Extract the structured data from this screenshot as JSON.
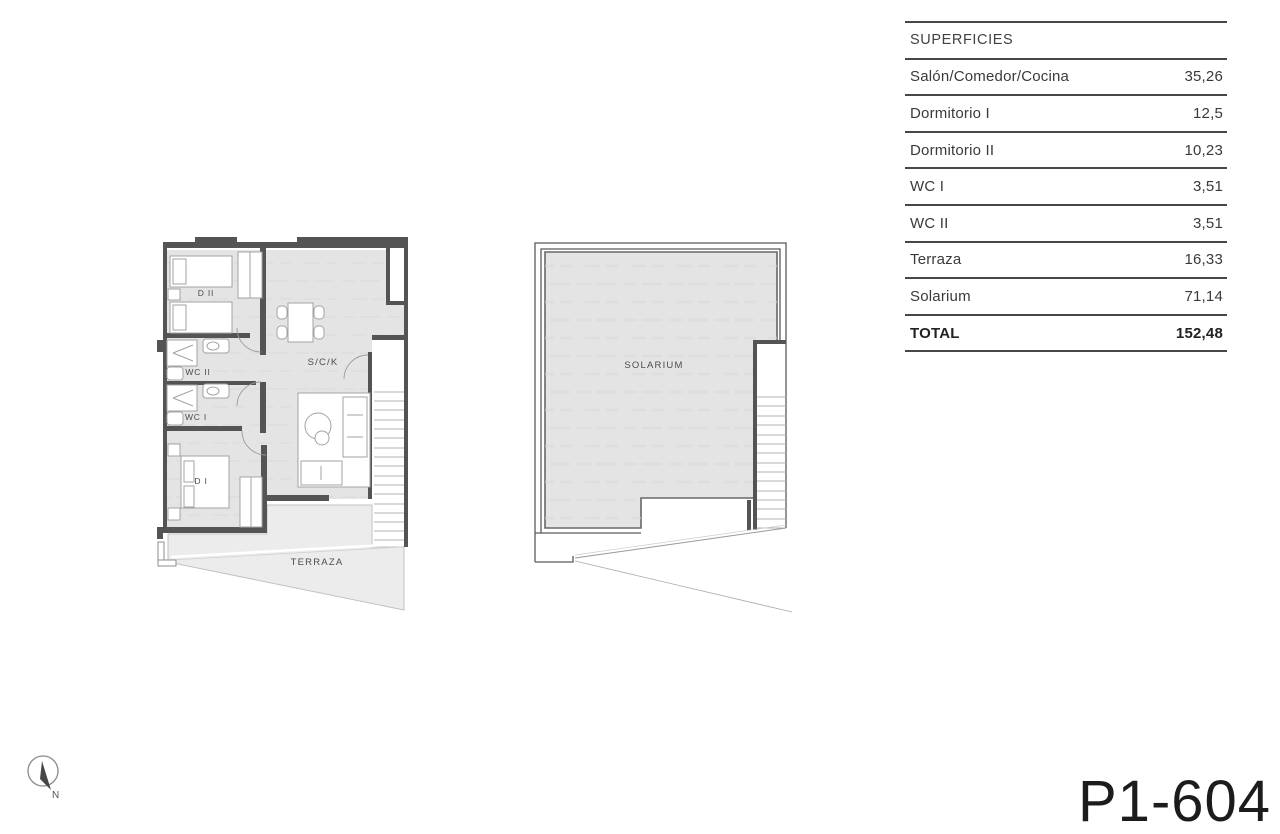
{
  "table": {
    "title": "SUPERFICIES",
    "rows": [
      {
        "label": "Salón/Comedor/Cocina",
        "value": "35,26"
      },
      {
        "label": "Dormitorio I",
        "value": "12,5"
      },
      {
        "label": "Dormitorio II",
        "value": "10,23"
      },
      {
        "label": "WC I",
        "value": "3,51"
      },
      {
        "label": "WC II",
        "value": "3,51"
      },
      {
        "label": "Terraza",
        "value": "16,33"
      },
      {
        "label": "Solarium",
        "value": "71,14"
      }
    ],
    "total": {
      "label": "TOTAL",
      "value": "152,48"
    }
  },
  "plans": {
    "apartment": {
      "labels": {
        "bedroom2": "D II",
        "wc2": "WC II",
        "wc1": "WC I",
        "bedroom1": "D I",
        "living": "S/C/K",
        "terrace": "TERRAZA"
      }
    },
    "roof": {
      "labels": {
        "solarium": "SOLARIUM"
      }
    }
  },
  "compass": {
    "label": "N"
  },
  "drawing_number": "P1-604",
  "colors": {
    "floor": "#e4e4e4",
    "terrace_floor": "#ececec",
    "wall": "#4f4f4f",
    "furniture_stroke": "#a3a3a3",
    "table_line": "#474747",
    "text": "#3a3a3a"
  }
}
